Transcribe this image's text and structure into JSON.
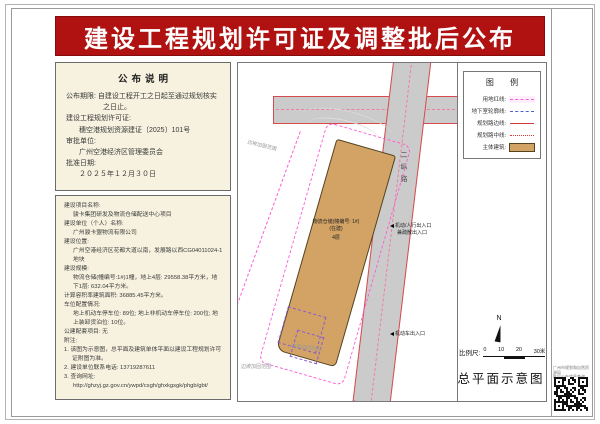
{
  "banner": {
    "title": "建设工程规划许可证及调整批后公布"
  },
  "notice": {
    "header": "公布说明",
    "rows": [
      "公布期限: 自建设工程开工之日起至通过规划核实之日止。",
      "建设工程规划许可证:",
      "穗空港规划资源建证〔2025〕101号",
      "审批单位:",
      "广州空港经济区管理委员会",
      "批准日期:",
      "２０２５年１２月３０日"
    ]
  },
  "project": {
    "rows": [
      "建设项目名称:",
      "骏卡集团研发及物流仓储配送中心项目",
      "建设单位（个人）名称:",
      "广州骏卡盟物流有限公司",
      "建设位置:",
      "广州空港经济区花都大道以南，发展路以西CG04011024-1地块",
      "建设规模:",
      "物流仓储(幢编号:1#)1幢，地上4层: 29558.38平方米，地下1层: 632.04平方米。",
      "计算容积率建筑面积: 36885.45平方米。",
      "车位配置情况:",
      "地上机动车停车位: 89位; 地上非机动车停车位: 200位; 地上装卸货泊位: 10位。",
      "公建配套项目: 无",
      "附注:",
      "1. 该图为示意图，总平面及建筑单体平面以建设工程规划许可证附图为准。",
      "2. 建设单位联系电话: 13719287611",
      "3. 查询网址:",
      "http://ghzyj.gz.gov.cn/ywpd/csgh/ghxkgsgk/phgb/gbt/"
    ]
  },
  "map": {
    "road_name_vertical": "二纵路",
    "building_label": "物流仓储(幢编号: 1#)(在建)",
    "building_floors": "4层",
    "entrance_label_1a": "机动/人行出入口",
    "entrance_label_1b": "兼疏散出入口",
    "entrance_label_2": "机动车出入口",
    "slope_note": "边坡加固范围"
  },
  "legend": {
    "title": "图  例",
    "items": [
      {
        "label": "用地红线:",
        "type": "pink-dash"
      },
      {
        "label": "地下室轮廓线:",
        "type": "blue-dash"
      },
      {
        "label": "规划路边线:",
        "type": "red-solid"
      },
      {
        "label": "规划路中线:",
        "type": "red-dotted"
      },
      {
        "label": "主体建筑:",
        "type": "tan-fill"
      }
    ]
  },
  "footer": {
    "north_label": "N",
    "scale_label": "比例尺:",
    "scale_ticks": [
      "0",
      "10",
      "20",
      "30米"
    ],
    "plan_caption": "总平面示意图"
  },
  "qr": {
    "caption_line1": "广州市规划和自然资源局",
    "caption_line2": "批后公布信息查询"
  },
  "colors": {
    "banner_red": "#b01212",
    "panel_beige": "#f6f2df",
    "building_tan": "#d2a365",
    "boundary_pink": "#ff5ad5",
    "road_edge_red": "#d84a4e",
    "basement_purple": "#8a5ad0",
    "road_gray": "#cccbcb"
  }
}
